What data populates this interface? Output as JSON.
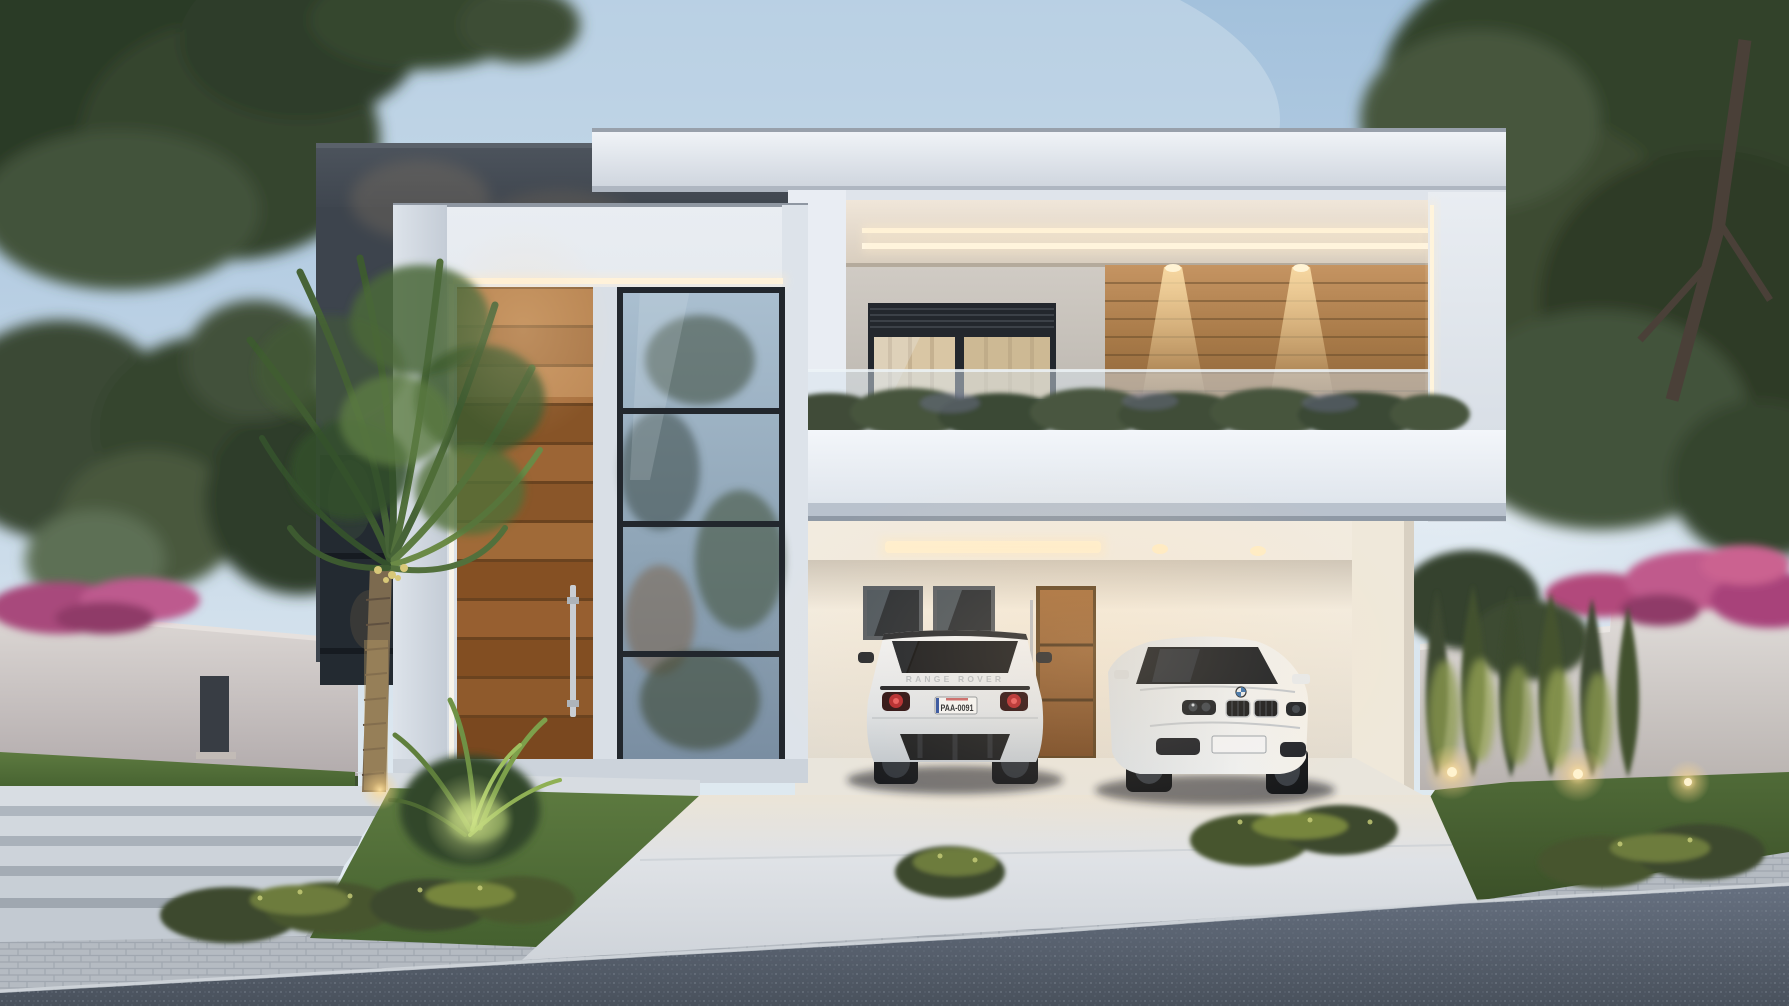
{
  "scene": {
    "setting": "modern two-story minimalist house exterior rendering at dusk",
    "elements": [
      "sky",
      "large trees left and right",
      "perimeter walls",
      "pink bougainvillea over walls",
      "row of uplit cypress trees",
      "palm tree",
      "charcoal rear volume",
      "white roof slabs",
      "balcony with glass railing and hedge",
      "wood accent wall with downlights",
      "recessed soffit with double LED strips",
      "tall wooden entry door with steel handle",
      "dark-framed glass curtain wall",
      "carport with two cars",
      "wooden carport door",
      "concrete steps",
      "lawn with ferns and flowering shrubs",
      "concrete driveway",
      "paver sidewalk",
      "asphalt road",
      "garden ground uplights"
    ]
  },
  "vehicles": {
    "range_rover": {
      "view": "rear",
      "badge_text": "RANGE ROVER",
      "license_plate": "PAA-0091",
      "body_color": "#eceef0"
    },
    "bmw": {
      "view": "front three-quarter",
      "license_plate_text": "",
      "body_color": "#eef0f1"
    }
  },
  "palette": {
    "sky_top": "#a3c1dc",
    "sky_horizon": "#e7eef3",
    "charcoal_wall": "#454c55",
    "white_wall": "#edf1f6",
    "beige_wall": "#c9c4bd",
    "wood": "#a06a38",
    "cream_carport": "#eee7db",
    "led_warm": "#ffe9c2",
    "glass": "#8fa5b6",
    "lawn": "#557239",
    "asphalt": "#525a66",
    "paver": "#b5bbc2",
    "flowers_pink": "#bd5a8e",
    "hedge": "#46523b",
    "taillight_red": "#b3262b"
  }
}
